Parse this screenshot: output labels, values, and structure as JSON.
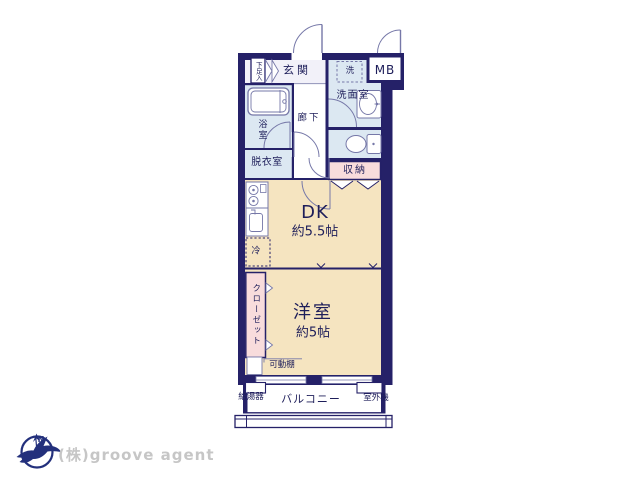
{
  "floorplan": {
    "labels": {
      "shoe_cabinet": "下足入",
      "entrance": "玄関",
      "washer": "洗",
      "meter_box": "MB",
      "washroom": "洗面室",
      "bathroom": "浴室",
      "hallway": "廊下",
      "dressing_room": "脱衣室",
      "storage": "収納",
      "dining_kitchen": "DK",
      "dining_kitchen_size": "約5.5帖",
      "refrigerator": "冷",
      "closet": "クローゼット",
      "western_room": "洋室",
      "western_room_size": "約5帖",
      "movable_shelf": "可動棚",
      "water_heater": "給湯器",
      "balcony": "バルコニー",
      "outdoor_unit": "室外機"
    },
    "colors": {
      "wall": "#252168",
      "room_beige": "#f5e4c0",
      "wet_area_blue": "#dce8f2",
      "closet_pink": "#f8dcdc",
      "entrance_floor": "#f2f1f9",
      "fixture_line": "#7678a8",
      "label_text": "#1e1e5a"
    }
  },
  "footer": {
    "compass_north": "N",
    "company": "(株)groove agent"
  }
}
